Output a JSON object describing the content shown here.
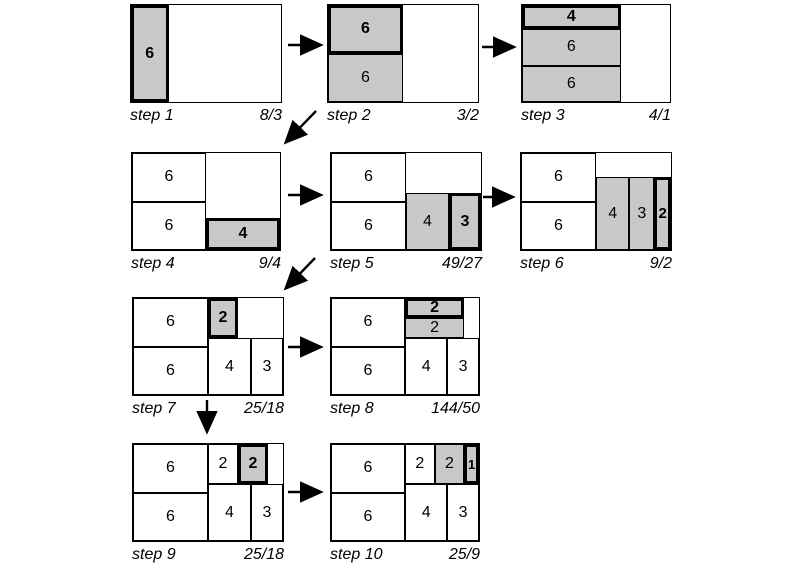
{
  "diagram": {
    "description": "squarified treemap construction sequence",
    "colors": {
      "highlight_fill": "#c8c8c8",
      "plain_fill": "#ffffff",
      "line": "#000000",
      "background": "#ffffff"
    },
    "box": {
      "height": 97,
      "units_x": 6,
      "units_y": 4
    },
    "steps": [
      {
        "name": "step 1",
        "ratio": "8/3",
        "x": 130,
        "y": 4,
        "w": 150,
        "tiles": [
          {
            "x": 0,
            "y": 0,
            "w": 1.5,
            "h": 4,
            "value": "6",
            "fill": "gray",
            "border": "thick",
            "bold": true
          }
        ]
      },
      {
        "name": "step 2",
        "ratio": "3/2",
        "x": 327,
        "y": 4,
        "w": 150,
        "tiles": [
          {
            "x": 0,
            "y": 0,
            "w": 3,
            "h": 2,
            "value": "6",
            "fill": "gray",
            "border": "thick",
            "bold": true
          },
          {
            "x": 0,
            "y": 2,
            "w": 3,
            "h": 2,
            "value": "6",
            "fill": "gray",
            "border": "thin",
            "bold": false
          }
        ]
      },
      {
        "name": "step 3",
        "ratio": "4/1",
        "x": 521,
        "y": 4,
        "w": 148,
        "tiles": [
          {
            "x": 0,
            "y": 0,
            "w": 4,
            "h": 1,
            "value": "4",
            "fill": "gray",
            "border": "thick",
            "bold": true
          },
          {
            "x": 0,
            "y": 1,
            "w": 4,
            "h": 1.5,
            "value": "6",
            "fill": "gray",
            "border": "thin",
            "bold": false
          },
          {
            "x": 0,
            "y": 2.5,
            "w": 4,
            "h": 1.5,
            "value": "6",
            "fill": "gray",
            "border": "thin",
            "bold": false
          }
        ]
      },
      {
        "name": "step 4",
        "ratio": "9/4",
        "x": 131,
        "y": 152,
        "w": 148,
        "tiles": [
          {
            "x": 0,
            "y": 0,
            "w": 3,
            "h": 2,
            "value": "6",
            "fill": "white",
            "border": "thin",
            "bold": false
          },
          {
            "x": 0,
            "y": 2,
            "w": 3,
            "h": 2,
            "value": "6",
            "fill": "white",
            "border": "thin",
            "bold": false
          },
          {
            "x": 3,
            "y": 2.6667,
            "w": 3,
            "h": 1.3333,
            "value": "4",
            "fill": "gray",
            "border": "thick",
            "bold": true
          }
        ]
      },
      {
        "name": "step 5",
        "ratio": "49/27",
        "x": 330,
        "y": 152,
        "w": 150,
        "tiles": [
          {
            "x": 0,
            "y": 0,
            "w": 3,
            "h": 2,
            "value": "6",
            "fill": "white",
            "border": "thin",
            "bold": false
          },
          {
            "x": 0,
            "y": 2,
            "w": 3,
            "h": 2,
            "value": "6",
            "fill": "white",
            "border": "thin",
            "bold": false
          },
          {
            "x": 3,
            "y": 1.6667,
            "w": 1.7143,
            "h": 2.3333,
            "value": "4",
            "fill": "gray",
            "border": "thin",
            "bold": false
          },
          {
            "x": 4.7143,
            "y": 1.6667,
            "w": 1.2857,
            "h": 2.3333,
            "value": "3",
            "fill": "gray",
            "border": "thick",
            "bold": true
          }
        ]
      },
      {
        "name": "step 6",
        "ratio": "9/2",
        "x": 520,
        "y": 152,
        "w": 150,
        "tiles": [
          {
            "x": 0,
            "y": 0,
            "w": 3,
            "h": 2,
            "value": "6",
            "fill": "white",
            "border": "thin",
            "bold": false
          },
          {
            "x": 0,
            "y": 2,
            "w": 3,
            "h": 2,
            "value": "6",
            "fill": "white",
            "border": "thin",
            "bold": false
          },
          {
            "x": 3,
            "y": 1,
            "w": 1.3333,
            "h": 3,
            "value": "4",
            "fill": "gray",
            "border": "thin",
            "bold": false
          },
          {
            "x": 4.3333,
            "y": 1,
            "w": 1,
            "h": 3,
            "value": "3",
            "fill": "gray",
            "border": "thin",
            "bold": false
          },
          {
            "x": 5.3333,
            "y": 1,
            "w": 0.6667,
            "h": 3,
            "value": "2",
            "fill": "gray",
            "border": "thick",
            "bold": true
          }
        ]
      },
      {
        "name": "step 7",
        "ratio": "25/18",
        "x": 132,
        "y": 297,
        "w": 150,
        "tiles": [
          {
            "x": 0,
            "y": 0,
            "w": 3,
            "h": 2,
            "value": "6",
            "fill": "white",
            "border": "thin",
            "bold": false
          },
          {
            "x": 0,
            "y": 2,
            "w": 3,
            "h": 2,
            "value": "6",
            "fill": "white",
            "border": "thin",
            "bold": false
          },
          {
            "x": 3,
            "y": 1.6667,
            "w": 1.7143,
            "h": 2.3333,
            "value": "4",
            "fill": "white",
            "border": "thin",
            "bold": false
          },
          {
            "x": 4.7143,
            "y": 1.6667,
            "w": 1.2857,
            "h": 2.3333,
            "value": "3",
            "fill": "white",
            "border": "thin",
            "bold": false
          },
          {
            "x": 3,
            "y": 0,
            "w": 1.2,
            "h": 1.6667,
            "value": "2",
            "fill": "gray",
            "border": "thick",
            "bold": true
          }
        ]
      },
      {
        "name": "step 8",
        "ratio": "144/50",
        "x": 330,
        "y": 297,
        "w": 148,
        "tiles": [
          {
            "x": 0,
            "y": 0,
            "w": 3,
            "h": 2,
            "value": "6",
            "fill": "white",
            "border": "thin",
            "bold": false
          },
          {
            "x": 0,
            "y": 2,
            "w": 3,
            "h": 2,
            "value": "6",
            "fill": "white",
            "border": "thin",
            "bold": false
          },
          {
            "x": 3,
            "y": 1.6667,
            "w": 1.7143,
            "h": 2.3333,
            "value": "4",
            "fill": "white",
            "border": "thin",
            "bold": false
          },
          {
            "x": 4.7143,
            "y": 1.6667,
            "w": 1.2857,
            "h": 2.3333,
            "value": "3",
            "fill": "white",
            "border": "thin",
            "bold": false
          },
          {
            "x": 3,
            "y": 0,
            "w": 2.4,
            "h": 0.8333,
            "value": "2",
            "fill": "gray",
            "border": "thick",
            "bold": true
          },
          {
            "x": 3,
            "y": 0.8333,
            "w": 2.4,
            "h": 0.8334,
            "value": "2",
            "fill": "gray",
            "border": "thin",
            "bold": false
          }
        ]
      },
      {
        "name": "step 9",
        "ratio": "25/18",
        "x": 132,
        "y": 443,
        "w": 150,
        "tiles": [
          {
            "x": 0,
            "y": 0,
            "w": 3,
            "h": 2,
            "value": "6",
            "fill": "white",
            "border": "thin",
            "bold": false
          },
          {
            "x": 0,
            "y": 2,
            "w": 3,
            "h": 2,
            "value": "6",
            "fill": "white",
            "border": "thin",
            "bold": false
          },
          {
            "x": 3,
            "y": 1.6667,
            "w": 1.7143,
            "h": 2.3333,
            "value": "4",
            "fill": "white",
            "border": "thin",
            "bold": false
          },
          {
            "x": 4.7143,
            "y": 1.6667,
            "w": 1.2857,
            "h": 2.3333,
            "value": "3",
            "fill": "white",
            "border": "thin",
            "bold": false
          },
          {
            "x": 3,
            "y": 0,
            "w": 1.2,
            "h": 1.6667,
            "value": "2",
            "fill": "white",
            "border": "thin",
            "bold": false
          },
          {
            "x": 4.2,
            "y": 0,
            "w": 1.2,
            "h": 1.6667,
            "value": "2",
            "fill": "gray",
            "border": "thick",
            "bold": true
          }
        ]
      },
      {
        "name": "step 10",
        "ratio": "25/9",
        "x": 330,
        "y": 443,
        "w": 148,
        "tiles": [
          {
            "x": 0,
            "y": 0,
            "w": 3,
            "h": 2,
            "value": "6",
            "fill": "white",
            "border": "thin",
            "bold": false
          },
          {
            "x": 0,
            "y": 2,
            "w": 3,
            "h": 2,
            "value": "6",
            "fill": "white",
            "border": "thin",
            "bold": false
          },
          {
            "x": 3,
            "y": 1.6667,
            "w": 1.7143,
            "h": 2.3333,
            "value": "4",
            "fill": "white",
            "border": "thin",
            "bold": false
          },
          {
            "x": 4.7143,
            "y": 1.6667,
            "w": 1.2857,
            "h": 2.3333,
            "value": "3",
            "fill": "white",
            "border": "thin",
            "bold": false
          },
          {
            "x": 3,
            "y": 0,
            "w": 1.2,
            "h": 1.6667,
            "value": "2",
            "fill": "white",
            "border": "thin",
            "bold": false
          },
          {
            "x": 4.2,
            "y": 0,
            "w": 1.2,
            "h": 1.6667,
            "value": "2",
            "fill": "gray",
            "border": "thin",
            "bold": false
          },
          {
            "x": 5.4,
            "y": 0,
            "w": 0.6,
            "h": 1.6667,
            "value": "1",
            "fill": "gray",
            "border": "thick",
            "bold": true
          }
        ]
      }
    ],
    "arrows": [
      {
        "x1": 288,
        "y1": 45,
        "x2": 319,
        "y2": 45
      },
      {
        "x1": 482,
        "y1": 47,
        "x2": 512,
        "y2": 47
      },
      {
        "x1": 316,
        "y1": 111,
        "x2": 287,
        "y2": 141
      },
      {
        "x1": 288,
        "y1": 195,
        "x2": 319,
        "y2": 195
      },
      {
        "x1": 483,
        "y1": 197,
        "x2": 511,
        "y2": 197
      },
      {
        "x1": 315,
        "y1": 258,
        "x2": 287,
        "y2": 287
      },
      {
        "x1": 288,
        "y1": 347,
        "x2": 319,
        "y2": 347
      },
      {
        "x1": 207,
        "y1": 400,
        "x2": 207,
        "y2": 430
      },
      {
        "x1": 288,
        "y1": 492,
        "x2": 319,
        "y2": 492
      }
    ]
  }
}
